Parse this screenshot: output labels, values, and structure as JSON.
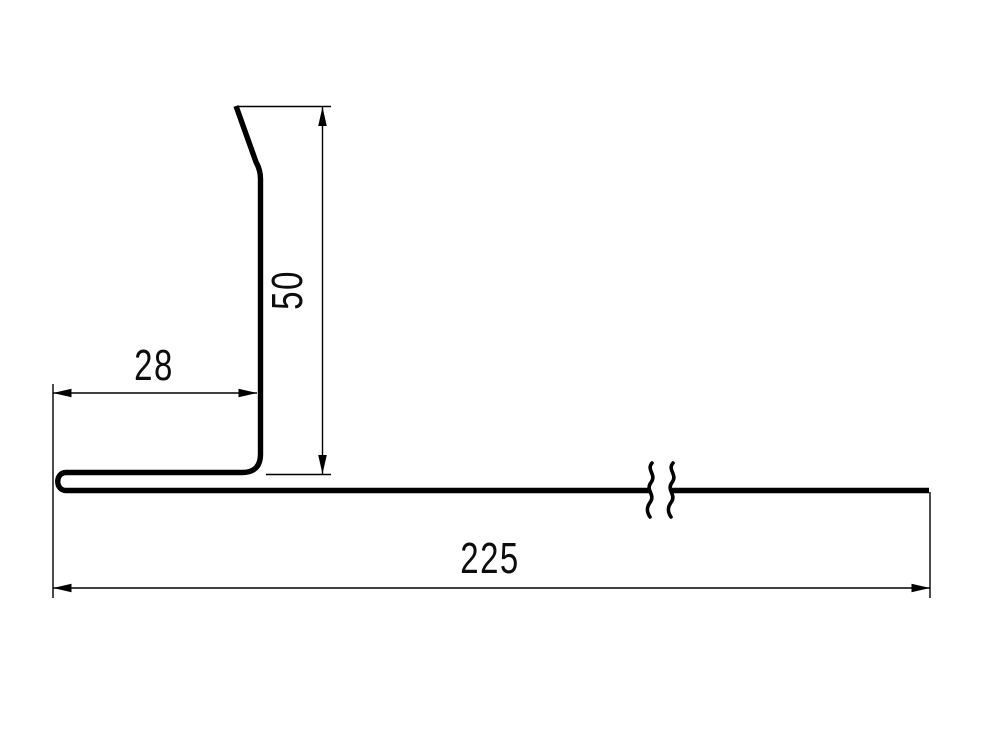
{
  "colors": {
    "background": "#ffffff",
    "line": "#000000",
    "text": "#0d0d0d"
  },
  "drawing": {
    "kind": "sheet-metal-profile-cross-section",
    "dimensions": {
      "flange": "28",
      "height": "50",
      "length": "225"
    }
  }
}
